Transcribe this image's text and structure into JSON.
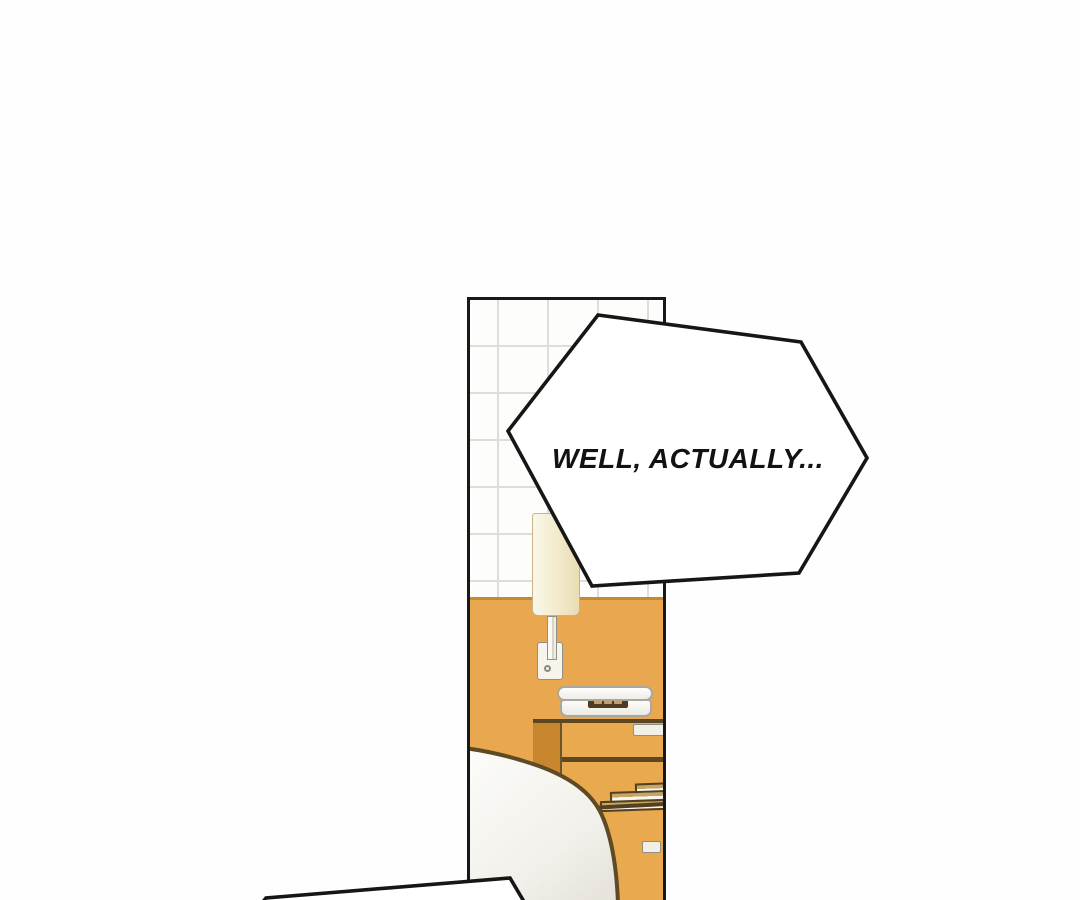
{
  "page": {
    "kind": "webtoon comic panel",
    "background_color": "#FEFEFE"
  },
  "speech_bubbles": {
    "main": {
      "text": "WELL, ACTUALLY...",
      "shape": "hexagon",
      "fill": "#FFFFFF",
      "border": "#161616"
    },
    "bottom_partial": {
      "text": "",
      "shape": "hexagon-partial"
    }
  },
  "scene": {
    "description": "bedroom interior panel",
    "objects": [
      "tiled wall",
      "orange wall",
      "wall lamp",
      "telephone",
      "nightstand",
      "drawer handles",
      "stacked books",
      "bed with blanket"
    ],
    "colors": {
      "wall_orange": "#E9A850",
      "wall_orange_edge": "#C8882E",
      "nightstand_front": "#E9A94F",
      "nightstand_side": "#C8862F",
      "wood_outline": "#5C4722",
      "lamp_shade": "#F3EACB",
      "tile_line": "#DEDED7",
      "bed_blanket": "#F4F2EC",
      "panel_border": "#181818"
    }
  }
}
